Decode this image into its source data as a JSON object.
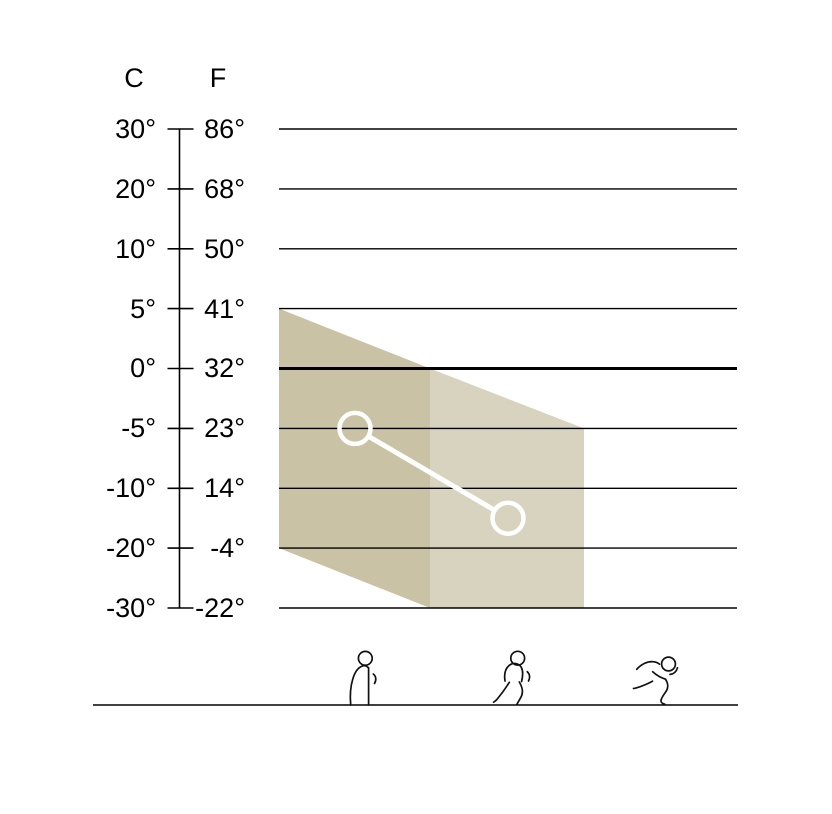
{
  "chart_data": {
    "type": "area",
    "title": "",
    "y_axis": {
      "unit_headers": [
        "C",
        "F"
      ],
      "ticks": [
        {
          "c": "30°",
          "f": "86°",
          "celsius": 30
        },
        {
          "c": "20°",
          "f": "68°",
          "celsius": 20
        },
        {
          "c": "10°",
          "f": "50°",
          "celsius": 10
        },
        {
          "c": "5°",
          "f": "41°",
          "celsius": 5
        },
        {
          "c": "0°",
          "f": "32°",
          "celsius": 0
        },
        {
          "c": "-5°",
          "f": "23°",
          "celsius": -5
        },
        {
          "c": "-10°",
          "f": "14°",
          "celsius": -10
        },
        {
          "c": "-20°",
          "f": "-4°",
          "celsius": -20
        },
        {
          "c": "-30°",
          "f": "-22°",
          "celsius": -30
        }
      ],
      "bold_gridline_at_celsius": 0
    },
    "x_axis": {
      "activities": [
        {
          "name": "standing",
          "icon": "person-standing-icon",
          "x_px": 365
        },
        {
          "name": "walking",
          "icon": "person-walking-icon",
          "x_px": 517
        },
        {
          "name": "running",
          "icon": "person-running-icon",
          "x_px": 662
        }
      ]
    },
    "comfort_band": {
      "dark_region": {
        "color": "#c9c2a4",
        "points": [
          {
            "x_px": 279,
            "celsius": 5
          },
          {
            "x_px": 430,
            "celsius": 0
          },
          {
            "x_px": 430,
            "celsius": -30
          },
          {
            "x_px": 279,
            "celsius": -20
          }
        ]
      },
      "light_region": {
        "color": "#d8d3be",
        "points": [
          {
            "x_px": 430,
            "celsius": 0
          },
          {
            "x_px": 584,
            "celsius": -5
          },
          {
            "x_px": 584,
            "celsius": -30
          },
          {
            "x_px": 430,
            "celsius": -30
          }
        ]
      }
    },
    "connector_series": {
      "color": "#ffffff",
      "marker": "open-circle",
      "points": [
        {
          "x_px": 355,
          "celsius": -5
        },
        {
          "x_px": 508,
          "celsius": -15
        }
      ]
    },
    "layout": {
      "grid_x1": 279,
      "grid_x2": 737,
      "axis_x": 179.5,
      "tick_x1": 167.5,
      "tick_x2": 193.5,
      "scale_top_y": 129,
      "scale_step_y": 59.875,
      "gridline_width": 1.4,
      "bold_gridline_width": 3,
      "baseline": {
        "x1": 93,
        "x2": 738,
        "y": 705
      },
      "line_color": "#000000",
      "icon_stroke_color": "#111111",
      "marker_radius": 15.5,
      "marker_stroke_width": 4.5,
      "connector_width": 5
    }
  }
}
